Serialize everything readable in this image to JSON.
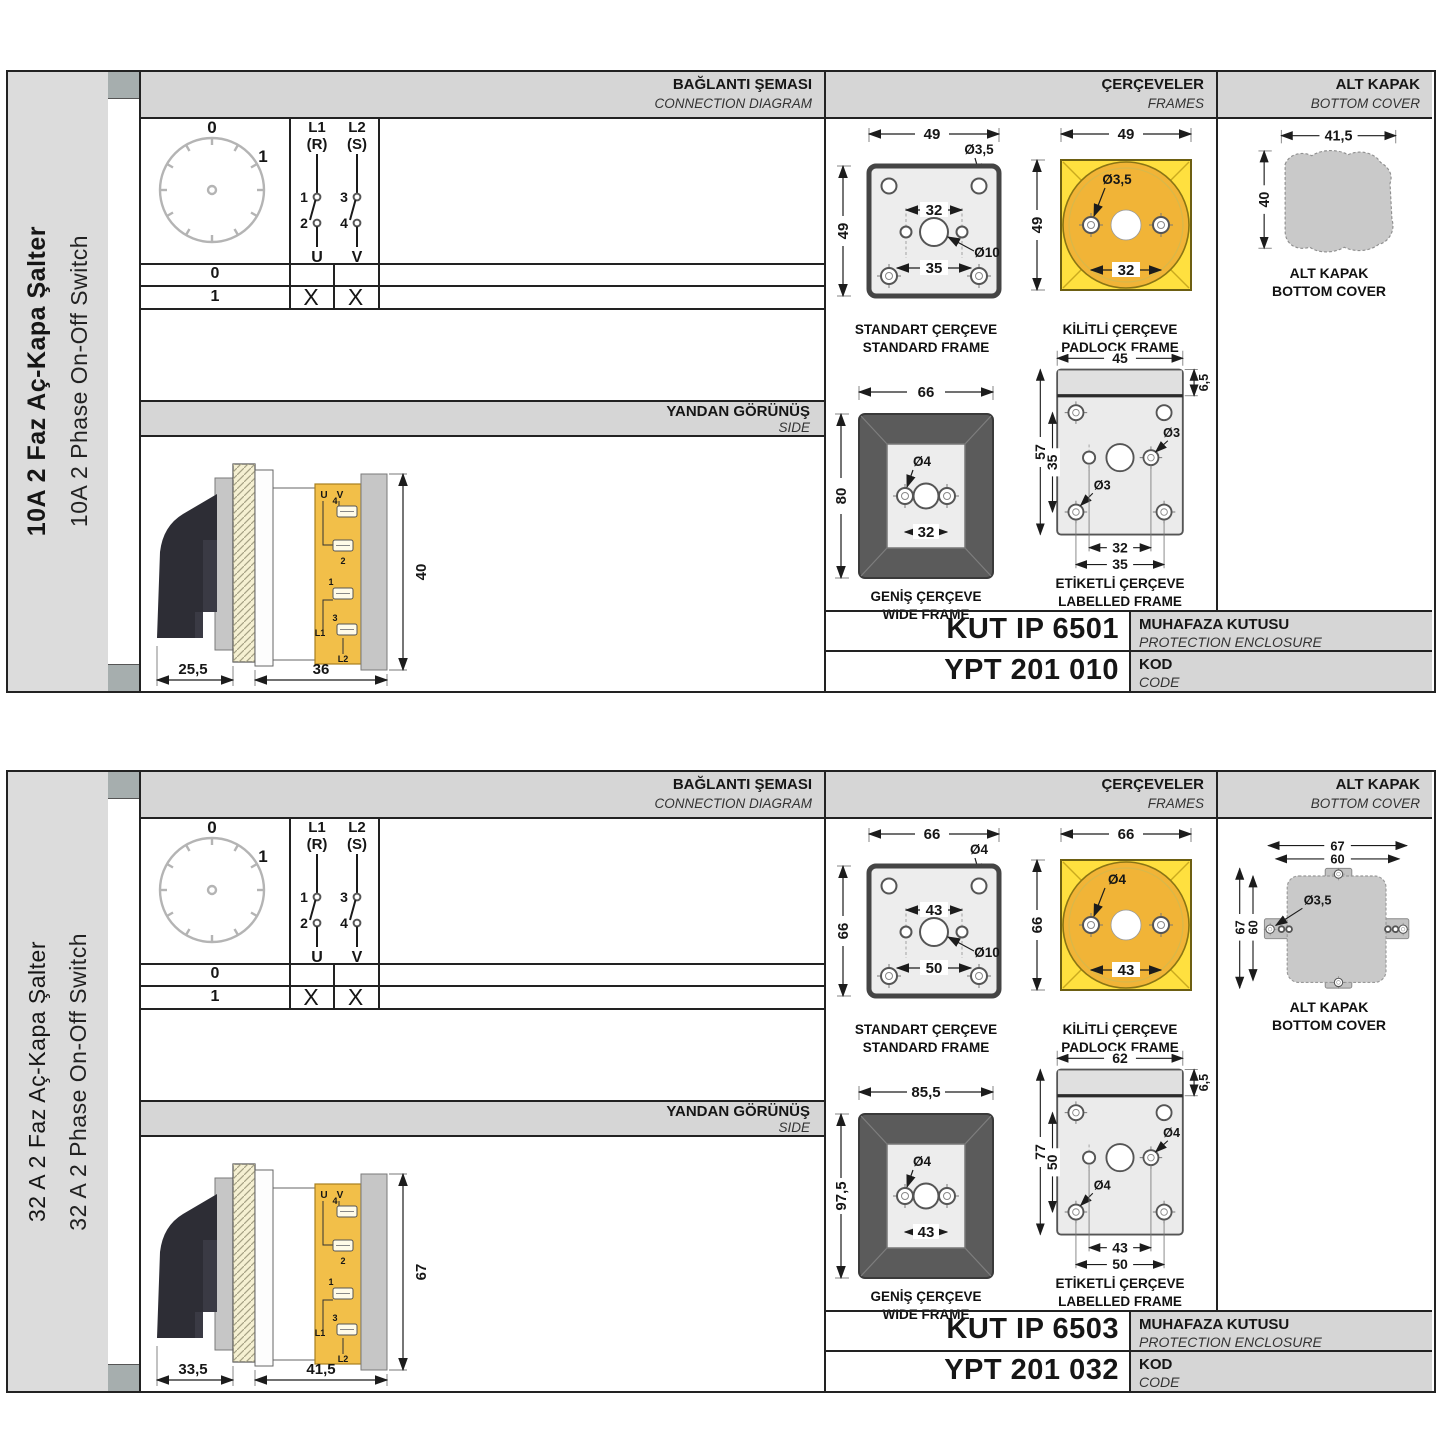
{
  "colors": {
    "accent_yellow": "#ffe03f",
    "accent_orange": "#f1b437",
    "label_yellow": "#f2bf49",
    "cover_gray": "#c9c9c9",
    "band_gray": "#d6d6d6"
  },
  "panels": [
    {
      "strip": {
        "title_tr": "10A 2 Faz Aç-Kapa Şalter",
        "title_en": "10A 2 Phase On-Off Switch"
      },
      "headers": {
        "connection_tr": "BAĞLANTI ŞEMASI",
        "connection_en": "CONNECTION DIAGRAM",
        "frames_tr": "ÇERÇEVELER",
        "frames_en": "FRAMES",
        "cover_tr": "ALT KAPAK",
        "cover_en": "BOTTOM COVER"
      },
      "diagram": {
        "dial": {
          "pos0": "0",
          "pos1": "1"
        },
        "pole1": {
          "line": "L1",
          "phase": "(R)",
          "c_top": "1",
          "c_bot": "2",
          "out": "U"
        },
        "pole2": {
          "line": "L2",
          "phase": "(S)",
          "c_top": "3",
          "c_bot": "4",
          "out": "V"
        },
        "rows": [
          {
            "pos": "0",
            "u": "",
            "v": ""
          },
          {
            "pos": "1",
            "u": "X",
            "v": "X"
          }
        ]
      },
      "side": {
        "title_tr": "YANDAN GÖRÜNÜŞ",
        "title_en": "SIDE",
        "dim_left": "25,5",
        "dim_right": "36",
        "dim_height": "40",
        "terms": {
          "u": "U",
          "v": "V",
          "n1": "1",
          "n2": "2",
          "n3": "3",
          "n4": "4",
          "l1": "L1",
          "l2": "L2"
        }
      },
      "frames": {
        "standard": {
          "cap_tr": "STANDART ÇERÇEVE",
          "cap_en": "STANDARD FRAME",
          "w": "49",
          "h": "49",
          "inner": "32",
          "lower": "35",
          "dia_corner": "Ø3,5",
          "dia_center": "Ø10"
        },
        "padlock": {
          "cap_tr": "KİLİTLİ ÇERÇEVE",
          "cap_en": "PADLOCK FRAME",
          "w": "49",
          "h": "49",
          "inner": "32",
          "dia": "Ø3,5"
        },
        "wide": {
          "cap_tr": "GENİŞ ÇERÇEVE",
          "cap_en": "WIDE FRAME",
          "w": "66",
          "h": "80",
          "inner": "32",
          "dia": "Ø4"
        },
        "labelled": {
          "cap_tr": "ETİKETLİ ÇERÇEVE",
          "cap_en": "LABELLED FRAME",
          "w": "45",
          "band": "6,5",
          "h": "57",
          "inner_v": "35",
          "inner": "32",
          "lower": "35",
          "dia1": "Ø3",
          "dia2": "Ø3"
        }
      },
      "cover": {
        "cap_tr": "ALT KAPAK",
        "cap_en": "BOTTOM COVER",
        "w": "41,5",
        "h": "40"
      },
      "codes": {
        "enclosure": "KUT IP 6501",
        "enclosure_tr": "MUHAFAZA KUTUSU",
        "enclosure_en": "PROTECTION ENCLOSURE",
        "code": "YPT 201 010",
        "code_tr": "KOD",
        "code_en": "CODE"
      }
    },
    {
      "strip": {
        "title_tr": "32 A 2 Faz Aç-Kapa Şalter",
        "title_en": "32 A 2 Phase On-Off Switch"
      },
      "headers": {
        "connection_tr": "BAĞLANTI ŞEMASI",
        "connection_en": "CONNECTION DIAGRAM",
        "frames_tr": "ÇERÇEVELER",
        "frames_en": "FRAMES",
        "cover_tr": "ALT KAPAK",
        "cover_en": "BOTTOM COVER"
      },
      "diagram": {
        "dial": {
          "pos0": "0",
          "pos1": "1"
        },
        "pole1": {
          "line": "L1",
          "phase": "(R)",
          "c_top": "1",
          "c_bot": "2",
          "out": "U"
        },
        "pole2": {
          "line": "L2",
          "phase": "(S)",
          "c_top": "3",
          "c_bot": "4",
          "out": "V"
        },
        "rows": [
          {
            "pos": "0",
            "u": "",
            "v": ""
          },
          {
            "pos": "1",
            "u": "X",
            "v": "X"
          }
        ]
      },
      "side": {
        "title_tr": "YANDAN GÖRÜNÜŞ",
        "title_en": "SIDE",
        "dim_left": "33,5",
        "dim_right": "41,5",
        "dim_height": "67",
        "terms": {
          "u": "U",
          "v": "V",
          "n1": "1",
          "n2": "2",
          "n3": "3",
          "n4": "4",
          "l1": "L1",
          "l2": "L2"
        }
      },
      "frames": {
        "standard": {
          "cap_tr": "STANDART ÇERÇEVE",
          "cap_en": "STANDARD FRAME",
          "w": "66",
          "h": "66",
          "inner": "43",
          "lower": "50",
          "dia_corner": "Ø4",
          "dia_center": "Ø10"
        },
        "padlock": {
          "cap_tr": "KİLİTLİ ÇERÇEVE",
          "cap_en": "PADLOCK FRAME",
          "w": "66",
          "h": "66",
          "inner": "43",
          "dia": "Ø4"
        },
        "wide": {
          "cap_tr": "GENİŞ ÇERÇEVE",
          "cap_en": "WIDE FRAME",
          "w": "85,5",
          "h": "97,5",
          "inner": "43",
          "dia": "Ø4"
        },
        "labelled": {
          "cap_tr": "ETİKETLİ ÇERÇEVE",
          "cap_en": "LABELLED FRAME",
          "w": "62",
          "band": "6,5",
          "h": "77",
          "inner_v": "50",
          "inner": "43",
          "lower": "50",
          "dia1": "Ø4",
          "dia2": "Ø4"
        }
      },
      "cover": {
        "cap_tr": "ALT KAPAK",
        "cap_en": "BOTTOM COVER",
        "w_outer": "67",
        "w_inner": "60",
        "h_outer": "67",
        "h_inner": "60",
        "dia": "Ø3,5"
      },
      "codes": {
        "enclosure": "KUT IP 6503",
        "enclosure_tr": "MUHAFAZA KUTUSU",
        "enclosure_en": "PROTECTION ENCLOSURE",
        "code": "YPT 201 032",
        "code_tr": "KOD",
        "code_en": "CODE"
      }
    }
  ]
}
